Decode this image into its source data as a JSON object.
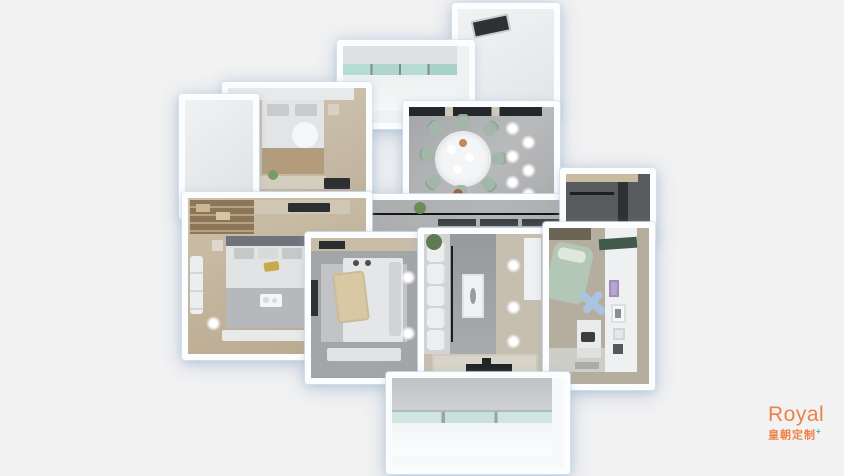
{
  "scene": {
    "description": "3D top-down dollhouse render of an apartment floor plan",
    "background_color": "#f2f2f3",
    "wall_color": "#fcfdff",
    "rooms": [
      {
        "name": "utility-room-top-right"
      },
      {
        "name": "balcony-top"
      },
      {
        "name": "small-bedroom"
      },
      {
        "name": "bathroom-left"
      },
      {
        "name": "dining-room"
      },
      {
        "name": "hallway"
      },
      {
        "name": "closet-nook"
      },
      {
        "name": "master-bedroom"
      },
      {
        "name": "second-bedroom"
      },
      {
        "name": "living-room"
      },
      {
        "name": "kids-room"
      },
      {
        "name": "balcony-bottom"
      }
    ],
    "palette": {
      "marble_floor": "#aeafb1",
      "wood_floor": "#c4b9a4",
      "sage_furniture": "#a2b6a9",
      "dark_fixture": "#2c2f32",
      "glass_teal": "#b5dcd4"
    }
  },
  "logo": {
    "brand": "Royal",
    "subtitle": "皇朝定制",
    "plus": "+",
    "brand_color": "#ee8147",
    "plus_color": "#35b0a0"
  }
}
